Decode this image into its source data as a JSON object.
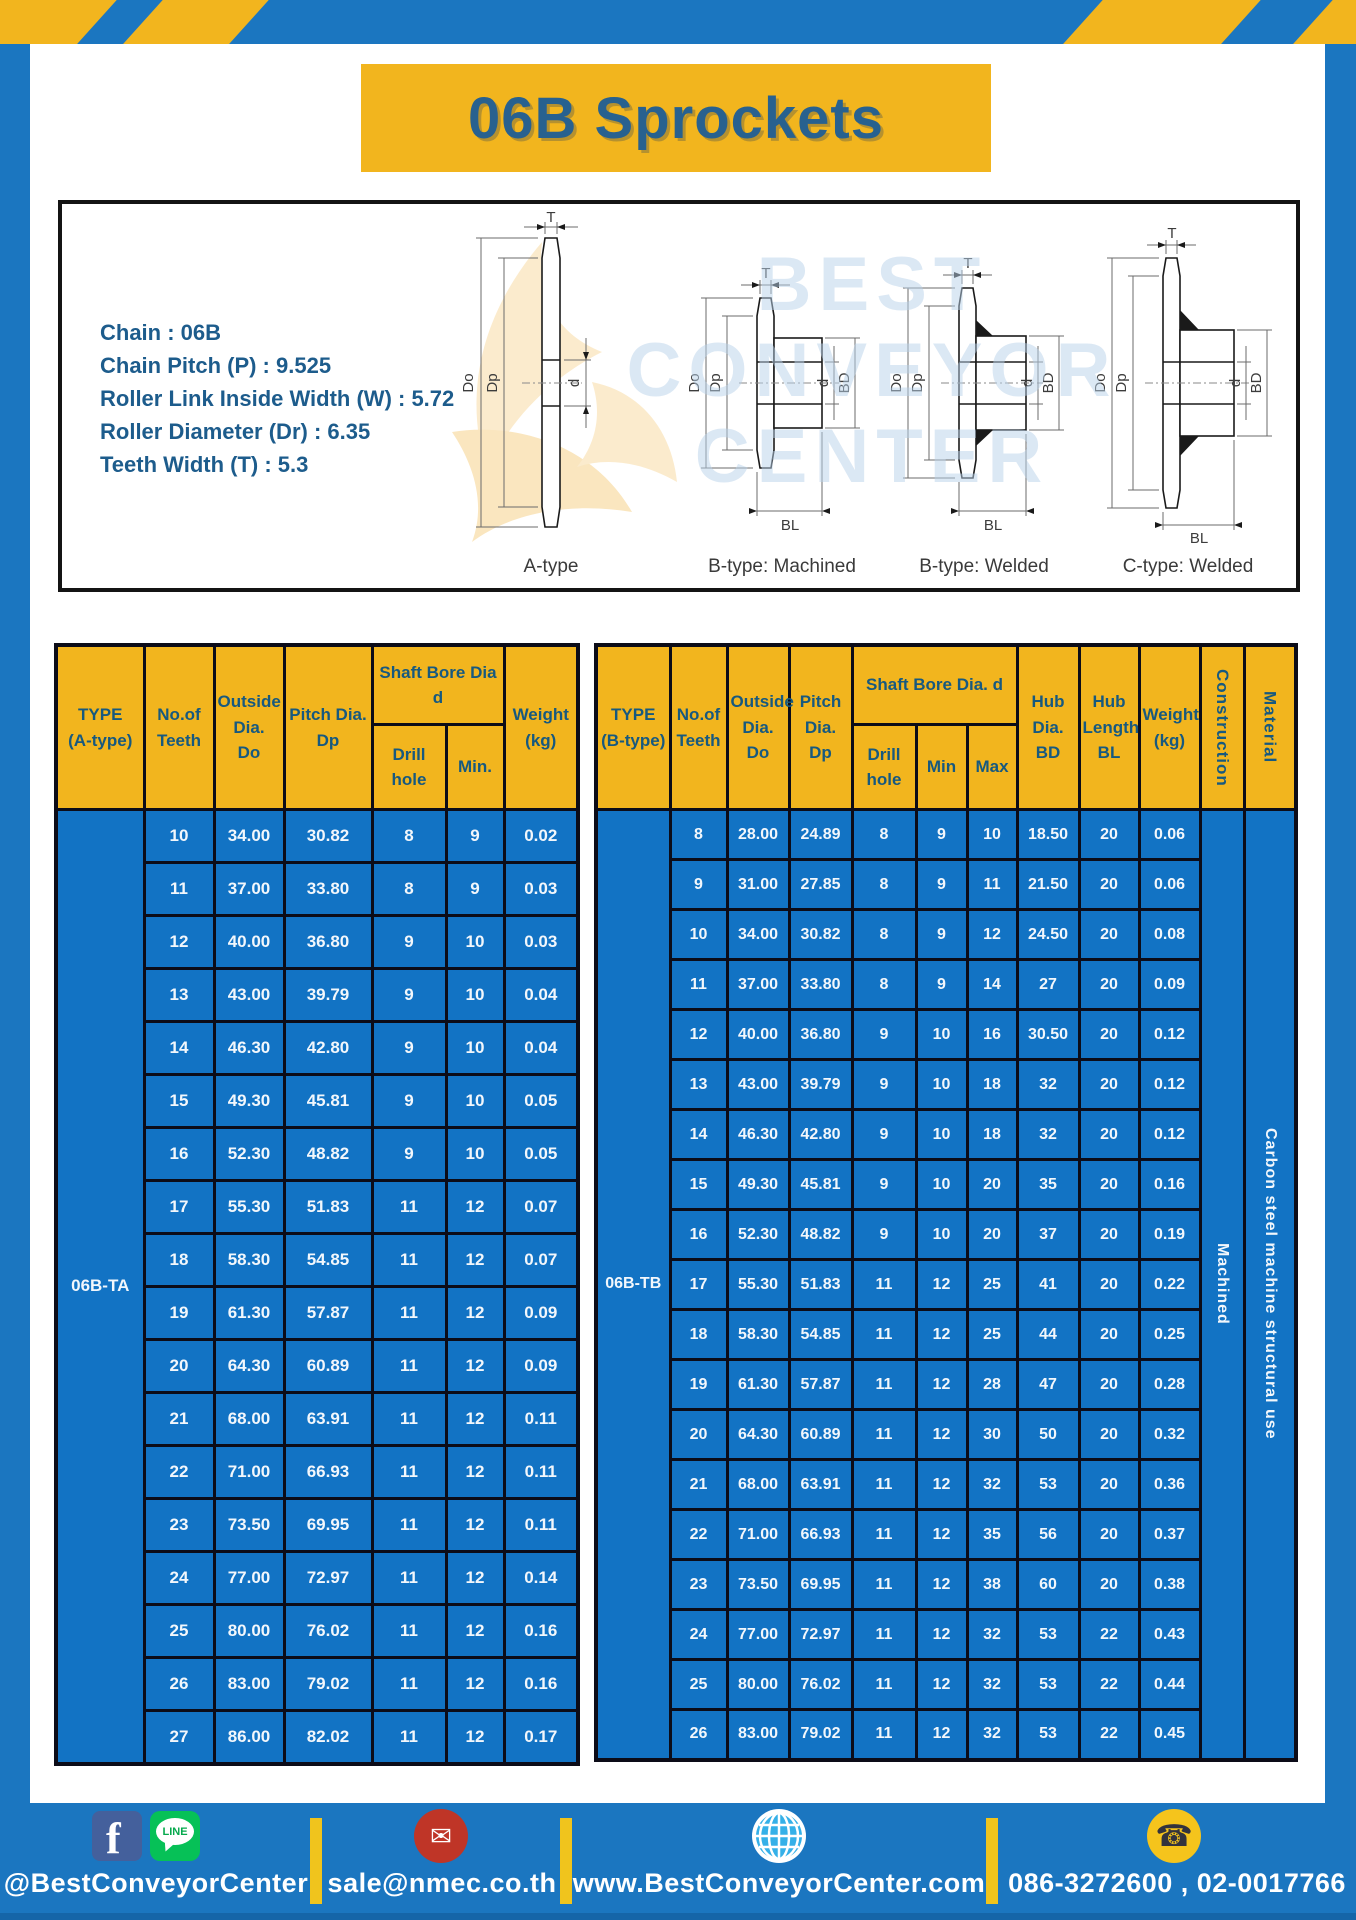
{
  "header": {
    "title": "06B Sprockets"
  },
  "specs": {
    "lines": [
      "Chain  : 06B",
      "Chain Pitch (P)  :  9.525",
      "Roller Link Inside Width (W)  :  5.72",
      "Roller Diameter (Dr)  : 6.35",
      "Teeth Width (T)  :  5.3"
    ]
  },
  "watermark": {
    "lines": [
      "BEST",
      "CONVEYOR",
      "CENTER"
    ]
  },
  "diagrams": {
    "dims": {
      "t": "T",
      "do": "Do",
      "dp": "Dp",
      "d": "d",
      "bd": "BD",
      "bl": "BL"
    },
    "items": [
      {
        "label": "A-type"
      },
      {
        "label": "B-type: Machined"
      },
      {
        "label": "B-type: Welded"
      },
      {
        "label": "C-type: Welded"
      }
    ]
  },
  "table_a": {
    "headers": {
      "type": "TYPE\n(A-type)",
      "teeth": "No.of\nTeeth",
      "outside": "Outside\nDia.\nDo",
      "pitch": "Pitch Dia.\nDp",
      "shaft_bore": "Shaft Bore Dia d",
      "drill": "Drill hole",
      "min": "Min.",
      "weight": "Weight\n(kg)"
    },
    "type_label": "06B-TA",
    "rows": [
      [
        "10",
        "34.00",
        "30.82",
        "8",
        "9",
        "0.02"
      ],
      [
        "11",
        "37.00",
        "33.80",
        "8",
        "9",
        "0.03"
      ],
      [
        "12",
        "40.00",
        "36.80",
        "9",
        "10",
        "0.03"
      ],
      [
        "13",
        "43.00",
        "39.79",
        "9",
        "10",
        "0.04"
      ],
      [
        "14",
        "46.30",
        "42.80",
        "9",
        "10",
        "0.04"
      ],
      [
        "15",
        "49.30",
        "45.81",
        "9",
        "10",
        "0.05"
      ],
      [
        "16",
        "52.30",
        "48.82",
        "9",
        "10",
        "0.05"
      ],
      [
        "17",
        "55.30",
        "51.83",
        "11",
        "12",
        "0.07"
      ],
      [
        "18",
        "58.30",
        "54.85",
        "11",
        "12",
        "0.07"
      ],
      [
        "19",
        "61.30",
        "57.87",
        "11",
        "12",
        "0.09"
      ],
      [
        "20",
        "64.30",
        "60.89",
        "11",
        "12",
        "0.09"
      ],
      [
        "21",
        "68.00",
        "63.91",
        "11",
        "12",
        "0.11"
      ],
      [
        "22",
        "71.00",
        "66.93",
        "11",
        "12",
        "0.11"
      ],
      [
        "23",
        "73.50",
        "69.95",
        "11",
        "12",
        "0.11"
      ],
      [
        "24",
        "77.00",
        "72.97",
        "11",
        "12",
        "0.14"
      ],
      [
        "25",
        "80.00",
        "76.02",
        "11",
        "12",
        "0.16"
      ],
      [
        "26",
        "83.00",
        "79.02",
        "11",
        "12",
        "0.16"
      ],
      [
        "27",
        "86.00",
        "82.02",
        "11",
        "12",
        "0.17"
      ]
    ]
  },
  "table_b": {
    "headers": {
      "type": "TYPE\n(B-type)",
      "teeth": "No.of\nTeeth",
      "outside": "Outside\nDia.\nDo",
      "pitch": "Pitch\nDia.\nDp",
      "shaft_bore": "Shaft Bore Dia.  d",
      "drill": "Drill hole",
      "min": "Min",
      "max": "Max",
      "hub_dia": "Hub\nDia.\nBD",
      "hub_len": "Hub\nLength\nBL",
      "weight": "Weight\n(kg)",
      "construction": "Construction",
      "material": "Material"
    },
    "type_label": "06B-TB",
    "construction": "Machined",
    "material": "Carbon  steel  machine  structural  use",
    "rows": [
      [
        "8",
        "28.00",
        "24.89",
        "8",
        "9",
        "10",
        "18.50",
        "20",
        "0.06"
      ],
      [
        "9",
        "31.00",
        "27.85",
        "8",
        "9",
        "11",
        "21.50",
        "20",
        "0.06"
      ],
      [
        "10",
        "34.00",
        "30.82",
        "8",
        "9",
        "12",
        "24.50",
        "20",
        "0.08"
      ],
      [
        "11",
        "37.00",
        "33.80",
        "8",
        "9",
        "14",
        "27",
        "20",
        "0.09"
      ],
      [
        "12",
        "40.00",
        "36.80",
        "9",
        "10",
        "16",
        "30.50",
        "20",
        "0.12"
      ],
      [
        "13",
        "43.00",
        "39.79",
        "9",
        "10",
        "18",
        "32",
        "20",
        "0.12"
      ],
      [
        "14",
        "46.30",
        "42.80",
        "9",
        "10",
        "18",
        "32",
        "20",
        "0.12"
      ],
      [
        "15",
        "49.30",
        "45.81",
        "9",
        "10",
        "20",
        "35",
        "20",
        "0.16"
      ],
      [
        "16",
        "52.30",
        "48.82",
        "9",
        "10",
        "20",
        "37",
        "20",
        "0.19"
      ],
      [
        "17",
        "55.30",
        "51.83",
        "11",
        "12",
        "25",
        "41",
        "20",
        "0.22"
      ],
      [
        "18",
        "58.30",
        "54.85",
        "11",
        "12",
        "25",
        "44",
        "20",
        "0.25"
      ],
      [
        "19",
        "61.30",
        "57.87",
        "11",
        "12",
        "28",
        "47",
        "20",
        "0.28"
      ],
      [
        "20",
        "64.30",
        "60.89",
        "11",
        "12",
        "30",
        "50",
        "20",
        "0.32"
      ],
      [
        "21",
        "68.00",
        "63.91",
        "11",
        "12",
        "32",
        "53",
        "20",
        "0.36"
      ],
      [
        "22",
        "71.00",
        "66.93",
        "11",
        "12",
        "35",
        "56",
        "20",
        "0.37"
      ],
      [
        "23",
        "73.50",
        "69.95",
        "11",
        "12",
        "38",
        "60",
        "20",
        "0.38"
      ],
      [
        "24",
        "77.00",
        "72.97",
        "11",
        "12",
        "32",
        "53",
        "22",
        "0.43"
      ],
      [
        "25",
        "80.00",
        "76.02",
        "11",
        "12",
        "32",
        "53",
        "22",
        "0.44"
      ],
      [
        "26",
        "83.00",
        "79.02",
        "11",
        "12",
        "32",
        "53",
        "22",
        "0.45"
      ]
    ]
  },
  "footer": {
    "line_text": "LINE",
    "items": {
      "social": "@BestConveyorCenter",
      "email": "sale@nmec.co.th",
      "web": "www.BestConveyorCenter.com",
      "phone": "086-3272600 , 02-0017766"
    }
  }
}
